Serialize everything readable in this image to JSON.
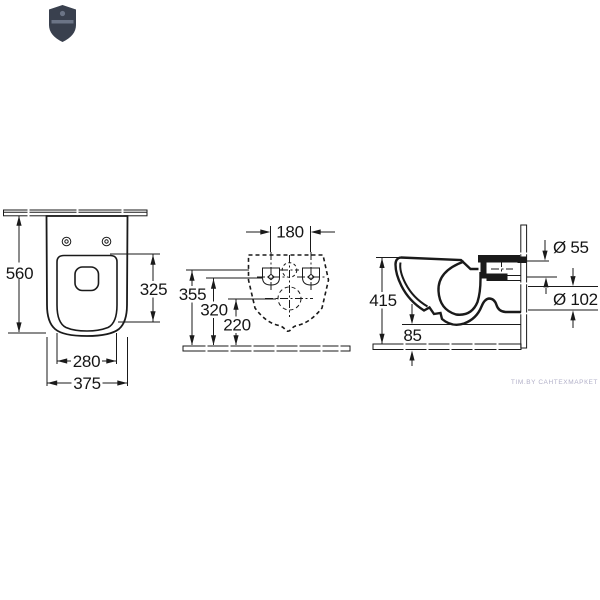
{
  "drawing": {
    "type": "wall-hung toilet installation dimensions, three orthographic views",
    "top_view": {
      "depth_label": "560",
      "seat_depth_label": "325",
      "seat_width_label": "280",
      "width_label": "375"
    },
    "rear_view": {
      "hole_spacing_label": "180",
      "inlet_height_label": "355",
      "fixing_height_label": "320",
      "outlet_height_label": "220"
    },
    "side_view": {
      "height_label": "415",
      "bottom_clearance_label": "85",
      "inlet_diameter_label": "Ø 55",
      "outlet_diameter_label": "Ø 102"
    },
    "watermark": "TIM.BY САНТЕХМАРКЕТ",
    "colors": {
      "line": "#1a1a1a",
      "logo": "#39404e",
      "watermark": "#b2b0c8",
      "background": "#ffffff"
    }
  }
}
